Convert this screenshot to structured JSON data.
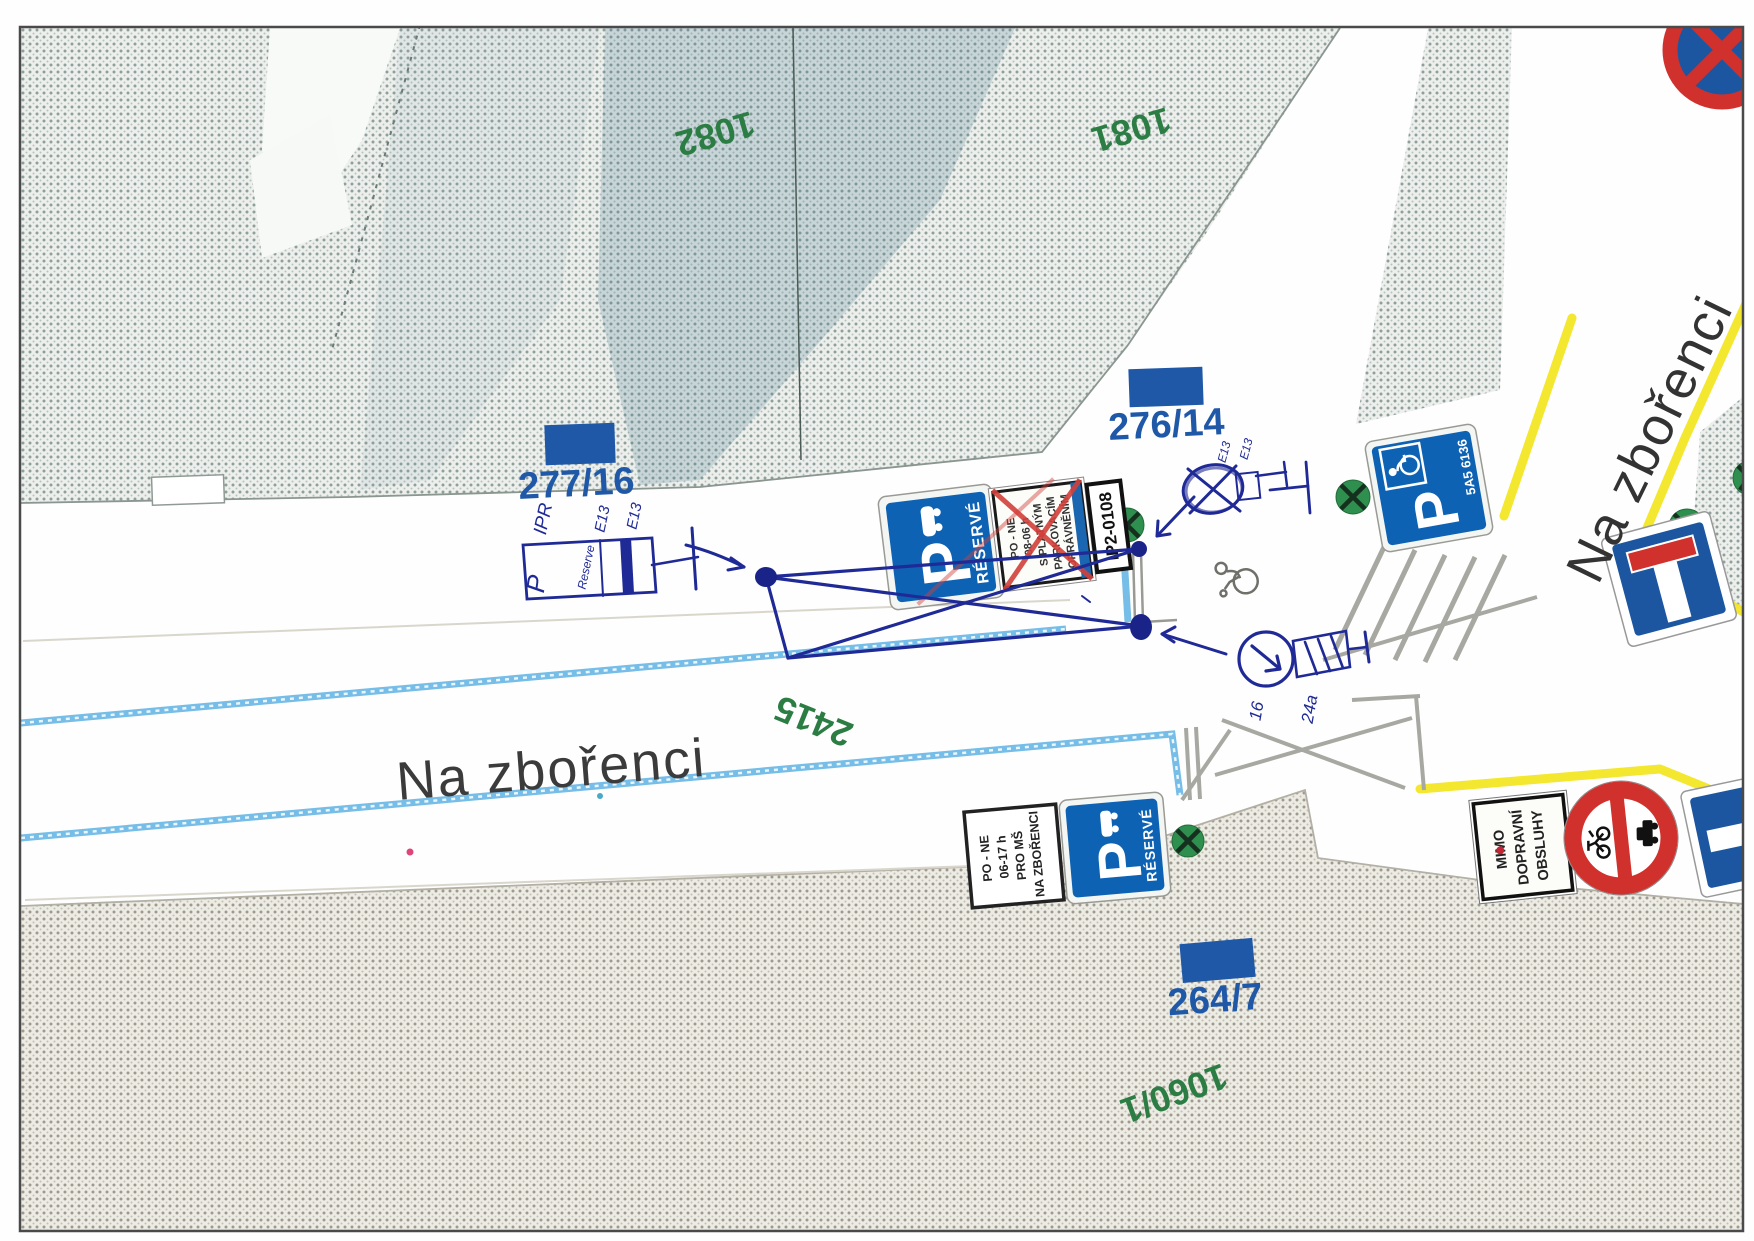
{
  "map": {
    "streets": {
      "main": "Na zbořenci"
    },
    "parcels": {
      "green": [
        {
          "id": "1082"
        },
        {
          "id": "1081"
        },
        {
          "id": "2415"
        },
        {
          "id": "1060/1"
        }
      ],
      "blue": [
        {
          "id": "277/16"
        },
        {
          "id": "276/14"
        },
        {
          "id": "264/7"
        }
      ]
    },
    "signs": {
      "reserve_main": {
        "p": "P",
        "title": "RÉSERVÉ",
        "panel_lines": [
          "PO - NE",
          "08-06 h",
          "S PLATNÝM",
          "PARKOVACÍM",
          "OPRÁVNĚNÍM"
        ],
        "tag": "IP2-0108"
      },
      "reserve_school": {
        "p": "P",
        "title": "RÉSERVÉ",
        "panel_lines": [
          "PO - NE",
          "06-17 h",
          "PRO MŠ",
          "NA ZBOŘENCI"
        ]
      },
      "disabled": {
        "p": "P",
        "plate": "5A5 6136"
      },
      "service": {
        "lines": [
          "MIMO",
          "DOPRAVNÍ",
          "OBSLUHY"
        ]
      }
    },
    "handwritten": {
      "agency": "IPR",
      "word": "Reserve",
      "code_a": "E13",
      "code_b": "E13",
      "code_c": "E13",
      "code_d": "E13",
      "p": "P",
      "count_left": "16",
      "count_right": "24a"
    },
    "colors": {
      "parcel_green": "#2c7d44",
      "parcel_blue": "#2058a8",
      "sign_blue": "#0e62b4",
      "sign_red": "#d0312d",
      "tree_green": "#2f8f4e",
      "utility_yellow": "#f2e51e",
      "lane_blue": "#6fb9e6",
      "ink": "#1f2a96"
    }
  }
}
